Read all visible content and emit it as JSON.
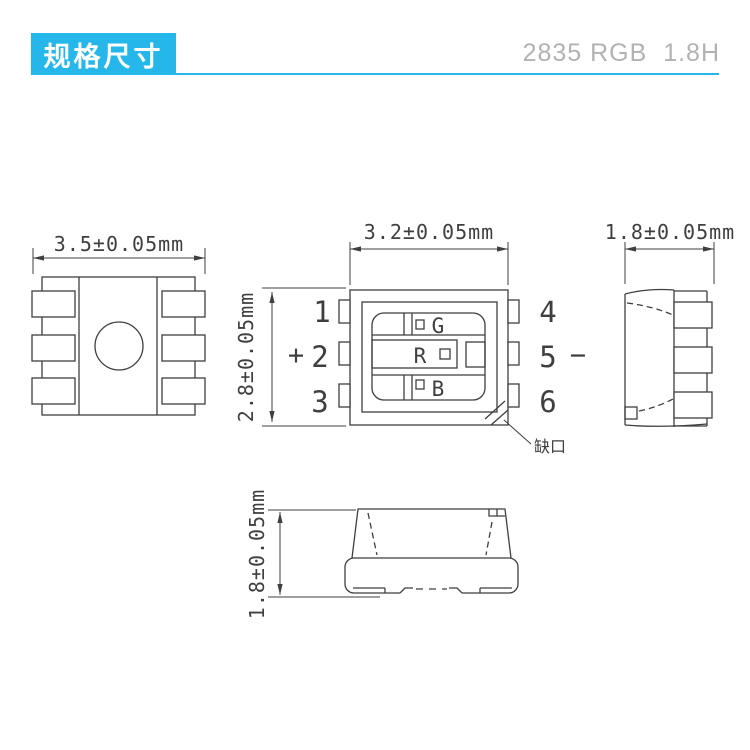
{
  "header": {
    "title": "规格尺寸",
    "product": "2835 RGB  1.8H",
    "accent_color": "#25b7ea",
    "product_text_color": "#b2b2b2",
    "title_text_color": "#ffffff"
  },
  "drawing": {
    "line_color": "#3f3f3f",
    "views": {
      "bottom_view": {
        "width_dim": "3.5±0.05mm"
      },
      "top_view": {
        "width_dim": "3.2±0.05mm",
        "height_dim": "2.8±0.05mm",
        "pins_left": [
          "1",
          "2",
          "3"
        ],
        "pins_right": [
          "4",
          "5",
          "6"
        ],
        "polarity_left": "+",
        "polarity_right": "−",
        "chips": [
          "G",
          "R",
          "B"
        ],
        "notch_label": "缺口"
      },
      "side_view": {
        "width_dim": "1.8±0.05mm"
      },
      "front_view": {
        "height_dim": "1.8±0.05mm"
      }
    }
  }
}
